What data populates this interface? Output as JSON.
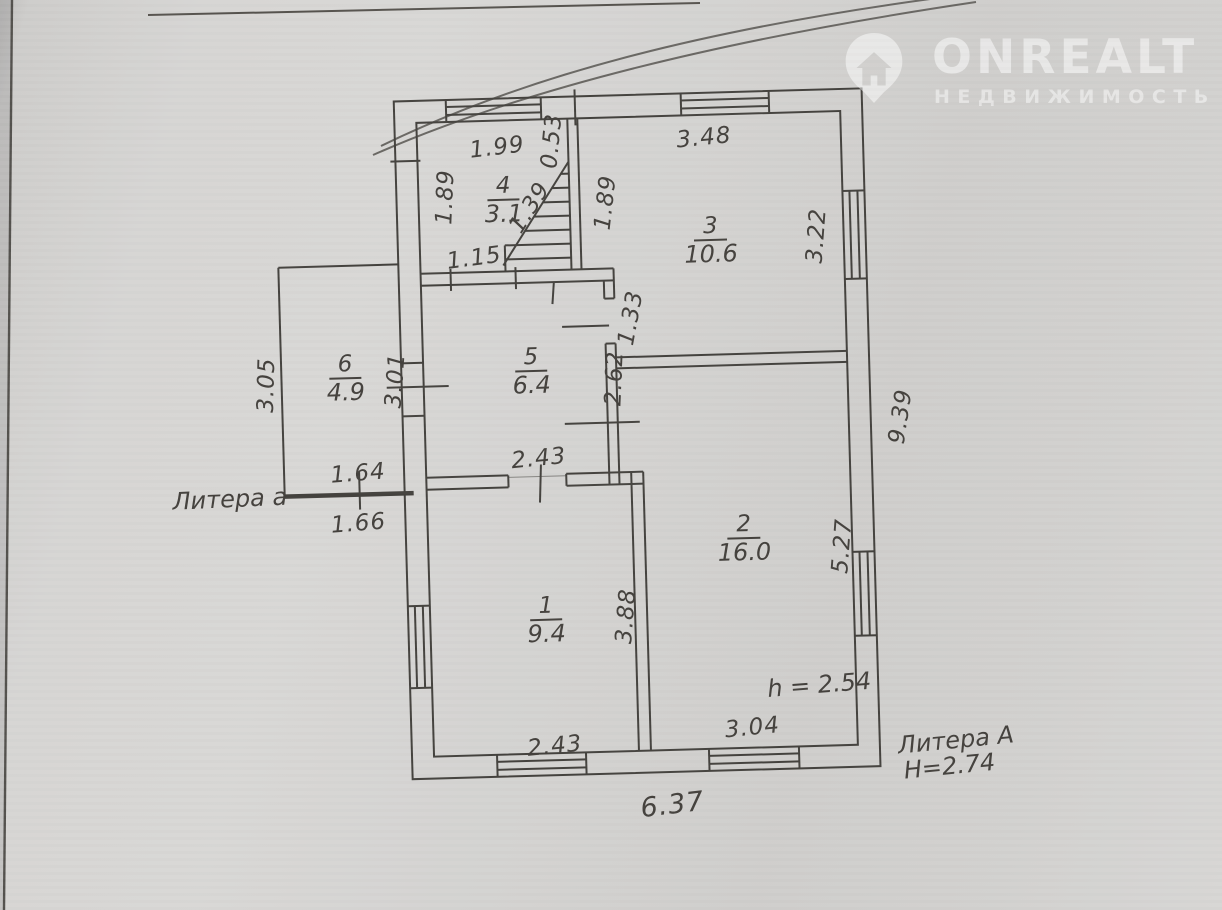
{
  "watermark": {
    "brand": "ONREALT",
    "tagline": "НЕДВИЖИМОСТЬ",
    "icon": "house-pin-icon"
  },
  "labels": {
    "litera_annex": "Литера а",
    "litera_main": "Литера А",
    "main_height": "H=2.74",
    "room_height": "h = 2.54"
  },
  "rooms": {
    "r1": {
      "num": "1",
      "area": "9.4"
    },
    "r2": {
      "num": "2",
      "area": "16.0"
    },
    "r3": {
      "num": "3",
      "area": "10.6"
    },
    "r4": {
      "num": "4",
      "area": "3.1"
    },
    "r5": {
      "num": "5",
      "area": "6.4"
    },
    "r6": {
      "num": "6",
      "area": "4.9"
    }
  },
  "dims": {
    "d199": "1.99",
    "d053": "0.53",
    "d348": "3.48",
    "d189l": "1.89",
    "d139": "1.39",
    "d189r": "1.89",
    "d322": "3.22",
    "d115": "1.15",
    "d133": "1.33",
    "d262": "2.62",
    "d301": "3.01",
    "d305": "3.05",
    "d939": "9.39",
    "d243t": "2.43",
    "d164": "1.64",
    "d166": "1.66",
    "d527": "5.27",
    "d388": "3.88",
    "d243b": "2.43",
    "d304": "3.04",
    "d637": "6.37"
  },
  "colors": {
    "paper": "#d3d2d0",
    "ink": "#45423e",
    "watermark": "#ffffff"
  }
}
